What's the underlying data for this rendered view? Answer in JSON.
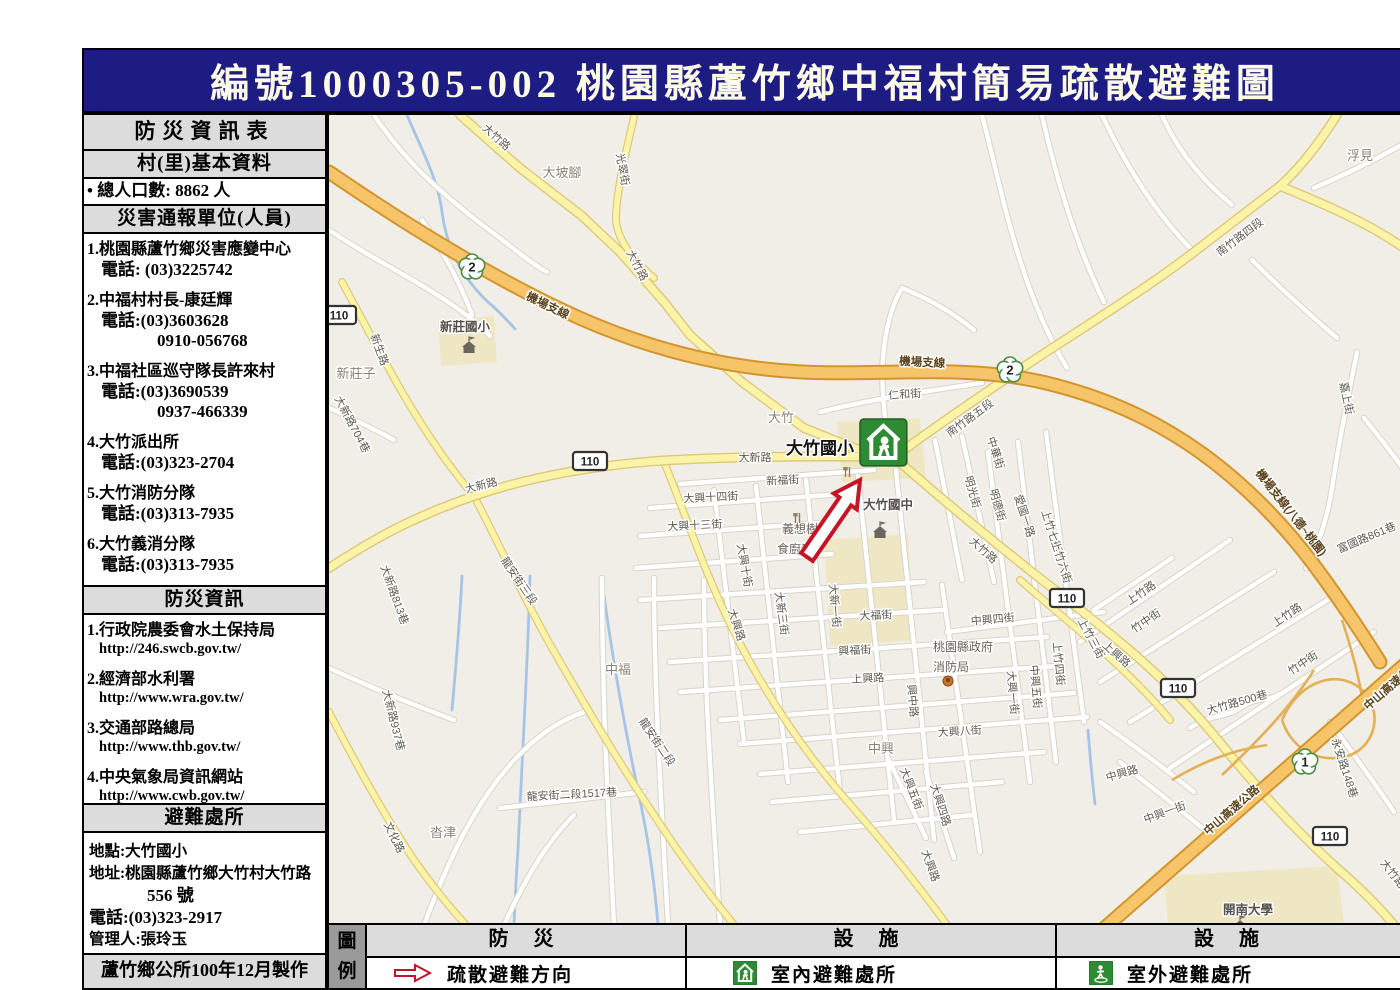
{
  "colors": {
    "header_bg": "#1c1c82",
    "header_text": "#fdfbe7",
    "arrow_red": "#c41425",
    "shelter_green": "#2e8b33",
    "land": "#f1eee7",
    "road_yellow": "#fbf3a8",
    "road_orange": "#f7c569",
    "water": "#a6c4e6",
    "panel_gray": "#dcdcdc"
  },
  "header": {
    "title": "編號1000305-002  桃園縣蘆竹鄉中福村簡易疏散避難圖"
  },
  "sidebar": {
    "title": "防災資訊表",
    "basic_header": "村(里)基本資料",
    "population": "• 總人口數:  8862  人",
    "contacts_header": "災害通報單位(人員)",
    "contacts": [
      {
        "lines": [
          "1.桃園縣蘆竹鄉災害應變中心",
          "電話: (03)3225742"
        ]
      },
      {
        "lines": [
          "2.中福村村長-康廷輝",
          "電話:(03)3603628",
          "0910-056768"
        ]
      },
      {
        "lines": [
          "3.中福社區巡守隊長許來村",
          "電話:(03)3690539",
          "0937-466339"
        ]
      },
      {
        "lines": [
          "4.大竹派出所",
          "電話:(03)323-2704"
        ]
      },
      {
        "lines": [
          "5.大竹消防分隊",
          "電話:(03)313-7935"
        ]
      },
      {
        "lines": [
          "6.大竹義消分隊",
          "電話:(03)313-7935"
        ]
      }
    ],
    "info_header": "防災資訊",
    "info_links": [
      {
        "name": "1.行政院農委會水土保持局",
        "url": "http://246.swcb.gov.tw/"
      },
      {
        "name": "2.經濟部水利署",
        "url": "http://www.wra.gov.tw/"
      },
      {
        "name": "3.交通部路總局",
        "url": "http://www.thb.gov.tw/"
      },
      {
        "name": "4.中央氣象局資訊網站",
        "url": "http://www.cwb.gov.tw/"
      }
    ],
    "shelter_header": "避難處所",
    "shelter": {
      "location": "地點:大竹國小",
      "address1": "地址:桃園縣蘆竹鄉大竹村大竹路",
      "address2": "556 號",
      "phone": "電話:(03)323-2917",
      "manager": "管理人:張玲玉",
      "capacity": "容納人數:  260    人"
    },
    "footer": "蘆竹鄉公所100年12月製作"
  },
  "legend": {
    "corner": [
      "圖",
      "例"
    ],
    "columns": [
      {
        "header": "防  災",
        "item": "疏散避難方向",
        "icon": "evacuation-arrow"
      },
      {
        "header": "設  施",
        "item": "室內避難處所",
        "icon": "indoor-shelter"
      },
      {
        "header": "設  施",
        "item": "室外避難處所",
        "icon": "outdoor-shelter"
      }
    ]
  },
  "map": {
    "arrow": "770.8,541 809.1,485.4 814.8,489.3 818,460 791.8,473.5 797.5,477.4 759.2,533",
    "areas": [
      "795,402 878,398 884,458 800,462",
      "782,520 866,514 872,620 788,626",
      "1122,856 1295,846 1302,905 1126,905",
      "396,300 452,296 455,342 399,346"
    ],
    "streams": [
      "M365,95 C382,135 396,160 400,192 C404,224 418,256 446,282 C458,292 466,301 473,309",
      "M420,556 C418,600 414,645 410,690",
      "M488,556 C486,640 480,740 476,830 C474,858 473,882 472,905",
      "M562,575 C572,650 585,720 600,790 C608,830 613,868 616,905",
      "M1046,710 C1048,736 1050,758 1053,784"
    ],
    "ramps": [
      "M1240,700 C1258,658 1300,648 1322,672 C1344,696 1330,736 1295,738 C1268,740 1248,724 1240,700",
      "M1180,755 C1215,722 1248,688 1272,650",
      "M1300,600 C1310,630 1318,660 1322,690",
      "M1130,760 C1160,742 1190,730 1225,725"
    ],
    "roads": [
      {
        "t": "w",
        "d": "M332,95 C362,140 396,170 434,200 C464,222 484,240 505,252"
      },
      {
        "t": "w",
        "d": "M287,210 C332,240 365,255 395,275 C415,287 432,300 448,316"
      },
      {
        "t": "w",
        "d": "M380,200 C400,230 418,262 430,295"
      },
      {
        "t": "w",
        "d": "M940,95 C952,140 962,190 978,240 C990,278 1005,315 1025,348"
      },
      {
        "t": "w",
        "d": "M1000,95 C1012,150 1032,220 1062,282"
      },
      {
        "t": "w",
        "d": "M1060,95 C1082,142 1112,192 1152,232"
      },
      {
        "t": "w",
        "d": "M1315,332 C1305,382 1297,422 1291,462 C1286,496 1278,522 1264,548"
      },
      {
        "t": "w",
        "d": "M1120,95 C1135,130 1160,160 1190,185"
      },
      {
        "t": "w",
        "d": "M1210,240 C1240,270 1268,295 1295,318"
      },
      {
        "t": "w",
        "d": "M1368,120 C1330,142 1300,156 1272,168"
      },
      {
        "t": "w",
        "d": "M848,432 C842,396 838,360 842,328 C845,303 851,283 860,268"
      },
      {
        "t": "w",
        "d": "M778,392 C830,379 885,371 940,363"
      },
      {
        "t": "w",
        "d": "M860,268 C885,278 910,292 932,310"
      },
      {
        "t": "w",
        "d": "M287,388 C310,398 330,408 352,420"
      },
      {
        "t": "w",
        "d": "M382,905 C402,852 424,802 454,762 C482,725 512,702 542,692"
      },
      {
        "t": "w",
        "d": "M462,905 C482,862 502,825 532,795"
      },
      {
        "t": "w",
        "d": "M458,788 L602,772"
      },
      {
        "t": "w",
        "d": "M560,558 C560,670 566,790 572,905"
      },
      {
        "t": "w",
        "d": "M612,558 C612,672 620,795 626,905"
      },
      {
        "t": "w",
        "d": "M662,560 C662,680 672,800 678,905"
      },
      {
        "t": "w",
        "d": "M287,648 C330,668 372,685 412,700"
      },
      {
        "t": "w",
        "d": "M638,464 L832,450"
      },
      {
        "t": "w",
        "d": "M608,488 L800,474"
      },
      {
        "t": "w",
        "d": "M598,516 L792,502"
      },
      {
        "t": "w",
        "d": "M594,548 L790,534"
      },
      {
        "t": "w",
        "d": "M598,580 L882,562"
      },
      {
        "t": "w",
        "d": "M618,608 L900,590"
      },
      {
        "t": "w",
        "d": "M628,642 L1005,617"
      },
      {
        "t": "w",
        "d": "M638,672 L1015,646"
      },
      {
        "t": "w",
        "d": "M678,700 L1032,673"
      },
      {
        "t": "w",
        "d": "M698,724 L1045,697"
      },
      {
        "t": "w",
        "d": "M718,754 L1002,732"
      },
      {
        "t": "w",
        "d": "M905,612 L1062,592"
      },
      {
        "t": "w",
        "d": "M730,782 L960,762"
      },
      {
        "t": "w",
        "d": "M758,812 L930,795"
      },
      {
        "t": "w",
        "d": "M672,470 L702,722"
      },
      {
        "t": "w",
        "d": "M714,466 L746,762"
      },
      {
        "t": "w",
        "d": "M764,460 L798,772"
      },
      {
        "t": "w",
        "d": "M816,456 L852,800"
      },
      {
        "t": "w",
        "d": "M854,450 L892,820"
      },
      {
        "t": "w",
        "d": "M900,565 L938,832"
      },
      {
        "t": "w",
        "d": "M946,432 L988,762"
      },
      {
        "t": "w",
        "d": "M976,422 L1014,742"
      },
      {
        "t": "w",
        "d": "M1004,412 L1042,702"
      },
      {
        "t": "w",
        "d": "M920,416 L952,562"
      },
      {
        "t": "w",
        "d": "M893,420 L920,560"
      },
      {
        "t": "w",
        "d": "M846,738 L884,818"
      },
      {
        "t": "w",
        "d": "M884,752 L912,838"
      },
      {
        "t": "w",
        "d": "M1038,622 L1188,520"
      },
      {
        "t": "w",
        "d": "M1058,662 L1232,552"
      },
      {
        "t": "w",
        "d": "M1088,702 L1292,576"
      },
      {
        "t": "w",
        "d": "M1128,748 L1332,612"
      },
      {
        "t": "w",
        "d": "M1052,590 L1130,538"
      },
      {
        "t": "w",
        "d": "M1058,702 C1090,724 1122,748 1152,772"
      },
      {
        "t": "w",
        "d": "M1078,742 C1110,768 1142,792 1172,818"
      },
      {
        "t": "w",
        "d": "M1288,702 C1310,732 1332,762 1352,792"
      },
      {
        "t": "w",
        "d": "M1148,708 C1168,694 1184,698 1198,688 C1214,676 1226,682 1238,674"
      },
      {
        "t": "w",
        "d": "M1322,398 C1340,420 1355,440 1368,458"
      },
      {
        "t": "ym",
        "d": "M592,97 C582,140 575,170 574,196 C573,216 590,240 612,258"
      },
      {
        "t": "ym",
        "d": "M300,262 C318,295 336,330 360,372 C382,410 408,448 432,476"
      },
      {
        "t": "ym",
        "d": "M432,476 C455,520 480,575 510,628 C540,680 575,740 612,795 C640,838 668,875 692,905"
      },
      {
        "t": "ym",
        "d": "M287,692 C312,740 340,792 372,840 C392,868 410,890 424,905"
      },
      {
        "t": "ym",
        "d": "M622,442 C642,490 662,552 692,612 C722,672 762,732 806,782 C845,826 878,868 905,905"
      },
      {
        "t": "ym",
        "d": "M978,560 C1010,588 1042,614 1068,638 C1092,660 1112,680 1128,700"
      },
      {
        "t": "y",
        "d": "M418,95 L478,148 L540,196 L578,232 L622,282 L648,315 L700,362 L762,408 L812,428 L852,437"
      },
      {
        "t": "y",
        "d": "M287,548 C330,520 368,498 432,476 C490,456 560,444 630,440 C710,436 790,436 852,437"
      },
      {
        "t": "y",
        "d": "M852,437 C900,402 950,368 995,338 C1050,302 1105,268 1152,232 C1185,207 1212,186 1238,166"
      },
      {
        "t": "y",
        "d": "M1238,166 C1258,148 1278,122 1295,95"
      },
      {
        "t": "y",
        "d": "M1238,166 C1272,180 1310,196 1340,214 C1352,221 1362,228 1368,232"
      },
      {
        "t": "y",
        "d": "M852,437 C900,480 952,522 1000,560 C1030,583 1062,608 1092,634 C1122,660 1152,690 1180,725 C1215,768 1255,812 1295,848 C1318,868 1338,888 1352,905"
      },
      {
        "t": "o",
        "d": "M287,152 C360,202 440,252 520,290 C600,328 680,348 760,352 C840,356 920,344 1000,362 C1060,376 1110,398 1158,432 C1200,462 1240,502 1272,545 C1295,576 1318,610 1338,642"
      },
      {
        "t": "o",
        "d": "M1058,912 L1368,640"
      }
    ],
    "labels": [
      {
        "t": "大竹路",
        "x": 452,
        "y": 120,
        "r": 42,
        "c": "st"
      },
      {
        "t": "光翠街",
        "x": 577,
        "y": 150,
        "r": 80,
        "c": "st"
      },
      {
        "t": "大坡腳",
        "x": 520,
        "y": 157,
        "r": 0,
        "c": "pl"
      },
      {
        "t": "大竹路",
        "x": 592,
        "y": 247,
        "r": 62,
        "c": "st"
      },
      {
        "t": "機場支線",
        "x": 504,
        "y": 289,
        "r": 26,
        "c": "hw"
      },
      {
        "t": "機場支線",
        "x": 880,
        "y": 346,
        "r": 3,
        "c": "hw"
      },
      {
        "t": "新生路",
        "x": 334,
        "y": 331,
        "r": 70,
        "c": "st"
      },
      {
        "t": "新莊子",
        "x": 314,
        "y": 358,
        "r": 0,
        "c": "pl"
      },
      {
        "t": "新莊國小",
        "x": 423,
        "y": 311,
        "r": 0,
        "c": "poi"
      },
      {
        "t": "南竹路四段",
        "x": 1200,
        "y": 220,
        "r": -37,
        "c": "st"
      },
      {
        "t": "浮見",
        "x": 1318,
        "y": 140,
        "r": 0,
        "c": "pl"
      },
      {
        "t": "南竹路五段",
        "x": 930,
        "y": 401,
        "r": -36,
        "c": "st"
      },
      {
        "t": "仁和街",
        "x": 863,
        "y": 378,
        "r": -4,
        "c": "st"
      },
      {
        "t": "大竹",
        "x": 739,
        "y": 402,
        "r": 0,
        "c": "pl"
      },
      {
        "t": "大竹國小",
        "x": 778,
        "y": 434,
        "r": 0,
        "c": "big"
      },
      {
        "t": "大新路",
        "x": 440,
        "y": 469,
        "r": -14,
        "c": "st"
      },
      {
        "t": "大新路",
        "x": 713,
        "y": 441,
        "r": 0,
        "c": "st"
      },
      {
        "t": "新福街",
        "x": 741,
        "y": 464,
        "r": -3,
        "c": "st"
      },
      {
        "t": "大興十四街",
        "x": 669,
        "y": 481,
        "r": -3,
        "c": "st"
      },
      {
        "t": "大興十三街",
        "x": 653,
        "y": 509,
        "r": -3,
        "c": "st"
      },
      {
        "t": "義想樹",
        "x": 758,
        "y": 513,
        "r": 0,
        "c": "poi2"
      },
      {
        "t": "食廚房",
        "x": 753,
        "y": 533,
        "r": 0,
        "c": "poi2"
      },
      {
        "t": "大竹國中",
        "x": 846,
        "y": 489,
        "r": 0,
        "c": "poi"
      },
      {
        "t": "大興十街",
        "x": 699,
        "y": 546,
        "r": 80,
        "c": "st"
      },
      {
        "t": "大新三街",
        "x": 736,
        "y": 594,
        "r": 82,
        "c": "st"
      },
      {
        "t": "大新一街",
        "x": 789,
        "y": 586,
        "r": 85,
        "c": "st"
      },
      {
        "t": "大福街",
        "x": 834,
        "y": 599,
        "r": -3,
        "c": "st"
      },
      {
        "t": "中興四街",
        "x": 951,
        "y": 603,
        "r": -5,
        "c": "st"
      },
      {
        "t": "興福街",
        "x": 813,
        "y": 634,
        "r": -3,
        "c": "st"
      },
      {
        "t": "桃園縣政府",
        "x": 921,
        "y": 631,
        "r": 0,
        "c": "poi2"
      },
      {
        "t": "消防局",
        "x": 909,
        "y": 651,
        "r": 0,
        "c": "poi2"
      },
      {
        "t": "上興路",
        "x": 826,
        "y": 662,
        "r": -3,
        "c": "st"
      },
      {
        "t": "興中路",
        "x": 867,
        "y": 681,
        "r": 85,
        "c": "st"
      },
      {
        "t": "大興一街",
        "x": 967,
        "y": 673,
        "r": 85,
        "c": "st"
      },
      {
        "t": "中興五街",
        "x": 990,
        "y": 667,
        "r": 85,
        "c": "st"
      },
      {
        "t": "上竹四街",
        "x": 1013,
        "y": 644,
        "r": 85,
        "c": "st"
      },
      {
        "t": "上竹三街",
        "x": 1046,
        "y": 620,
        "r": 62,
        "c": "st"
      },
      {
        "t": "上興路",
        "x": 1072,
        "y": 637,
        "r": 42,
        "c": "st"
      },
      {
        "t": "大興八街",
        "x": 918,
        "y": 715,
        "r": -4,
        "c": "st"
      },
      {
        "t": "中興",
        "x": 839,
        "y": 733,
        "r": 0,
        "c": "pl"
      },
      {
        "t": "大興五街",
        "x": 866,
        "y": 770,
        "r": 68,
        "c": "st"
      },
      {
        "t": "大興四路",
        "x": 895,
        "y": 786,
        "r": 72,
        "c": "st"
      },
      {
        "t": "大興路",
        "x": 691,
        "y": 606,
        "r": 72,
        "c": "st"
      },
      {
        "t": "大興路",
        "x": 885,
        "y": 847,
        "r": 70,
        "c": "st"
      },
      {
        "t": "中華街",
        "x": 950,
        "y": 434,
        "r": 72,
        "c": "st"
      },
      {
        "t": "明光街",
        "x": 927,
        "y": 473,
        "r": 74,
        "c": "st"
      },
      {
        "t": "明德街",
        "x": 952,
        "y": 486,
        "r": 74,
        "c": "st"
      },
      {
        "t": "愛國一路",
        "x": 979,
        "y": 497,
        "r": 72,
        "c": "st"
      },
      {
        "t": "上竹七街",
        "x": 1006,
        "y": 512,
        "r": 72,
        "c": "st"
      },
      {
        "t": "上竹六街",
        "x": 1016,
        "y": 543,
        "r": 72,
        "c": "st"
      },
      {
        "t": "大竹路",
        "x": 939,
        "y": 533,
        "r": 42,
        "c": "st"
      },
      {
        "t": "上竹路",
        "x": 1101,
        "y": 576,
        "r": -34,
        "c": "st"
      },
      {
        "t": "竹中街",
        "x": 1106,
        "y": 604,
        "r": -34,
        "c": "st"
      },
      {
        "t": "上竹路",
        "x": 1247,
        "y": 598,
        "r": -34,
        "c": "st"
      },
      {
        "t": "竹中街",
        "x": 1263,
        "y": 646,
        "r": -34,
        "c": "st"
      },
      {
        "t": "嘉上街",
        "x": 1301,
        "y": 379,
        "r": 78,
        "c": "st"
      },
      {
        "t": "富國路861巷",
        "x": 1326,
        "y": 521,
        "r": -23,
        "c": "st"
      },
      {
        "t": "機場支線(八德~桃園)",
        "x": 1246,
        "y": 495,
        "r": 52,
        "c": "hw"
      },
      {
        "t": "中興路",
        "x": 1081,
        "y": 757,
        "r": -16,
        "c": "st"
      },
      {
        "t": "中興一街",
        "x": 1124,
        "y": 796,
        "r": -20,
        "c": "st"
      },
      {
        "t": "大竹路500巷",
        "x": 1196,
        "y": 686,
        "r": -16,
        "c": "st"
      },
      {
        "t": "中山高速公路",
        "x": 1192,
        "y": 793,
        "r": -41,
        "c": "hw"
      },
      {
        "t": "中山高速公路",
        "x": 1352,
        "y": 668,
        "r": -41,
        "c": "hw"
      },
      {
        "t": "開南大學",
        "x": 1206,
        "y": 894,
        "r": 0,
        "c": "poi"
      },
      {
        "t": "中福",
        "x": 576,
        "y": 654,
        "r": 0,
        "c": "pl"
      },
      {
        "t": "沓津",
        "x": 401,
        "y": 817,
        "r": 0,
        "c": "pl"
      },
      {
        "t": "龍安街三段",
        "x": 474,
        "y": 563,
        "r": 56,
        "c": "st"
      },
      {
        "t": "龍安街二段",
        "x": 612,
        "y": 724,
        "r": 56,
        "c": "st"
      },
      {
        "t": "龍安街二段1517巷",
        "x": 530,
        "y": 778,
        "r": -3,
        "c": "st"
      },
      {
        "t": "大新路813巷",
        "x": 349,
        "y": 576,
        "r": 70,
        "c": "st"
      },
      {
        "t": "大新路937巷",
        "x": 348,
        "y": 701,
        "r": 76,
        "c": "st"
      },
      {
        "t": "大新路704巷",
        "x": 307,
        "y": 406,
        "r": 62,
        "c": "st"
      },
      {
        "t": "文化路",
        "x": 349,
        "y": 819,
        "r": 64,
        "c": "st"
      },
      {
        "t": "永安路148巷",
        "x": 1299,
        "y": 749,
        "r": 72,
        "c": "st"
      },
      {
        "t": "大竹路",
        "x": 1348,
        "y": 856,
        "r": 52,
        "c": "st"
      }
    ],
    "shields": [
      {
        "n": "2",
        "p": 1,
        "x": 430,
        "y": 247
      },
      {
        "n": "2",
        "p": 1,
        "x": 968,
        "y": 350
      },
      {
        "n": "1",
        "p": 1,
        "x": 1263,
        "y": 742
      },
      {
        "n": "110",
        "x": 297,
        "y": 295
      },
      {
        "n": "110",
        "x": 548,
        "y": 441
      },
      {
        "n": "110",
        "x": 1025,
        "y": 578
      },
      {
        "n": "110",
        "x": 1136,
        "y": 668
      },
      {
        "n": "110",
        "x": 1288,
        "y": 816
      }
    ],
    "icons": [
      {
        "k": "school",
        "x": 427,
        "y": 327
      },
      {
        "k": "school",
        "x": 838,
        "y": 512
      },
      {
        "k": "school",
        "x": 1198,
        "y": 906
      },
      {
        "k": "fire",
        "x": 906,
        "y": 661
      },
      {
        "k": "fork",
        "x": 806,
        "y": 452
      },
      {
        "k": "fork",
        "x": 756,
        "y": 498
      },
      {
        "k": "shelter",
        "x": 818,
        "y": 399,
        "s": 1.95
      }
    ]
  }
}
